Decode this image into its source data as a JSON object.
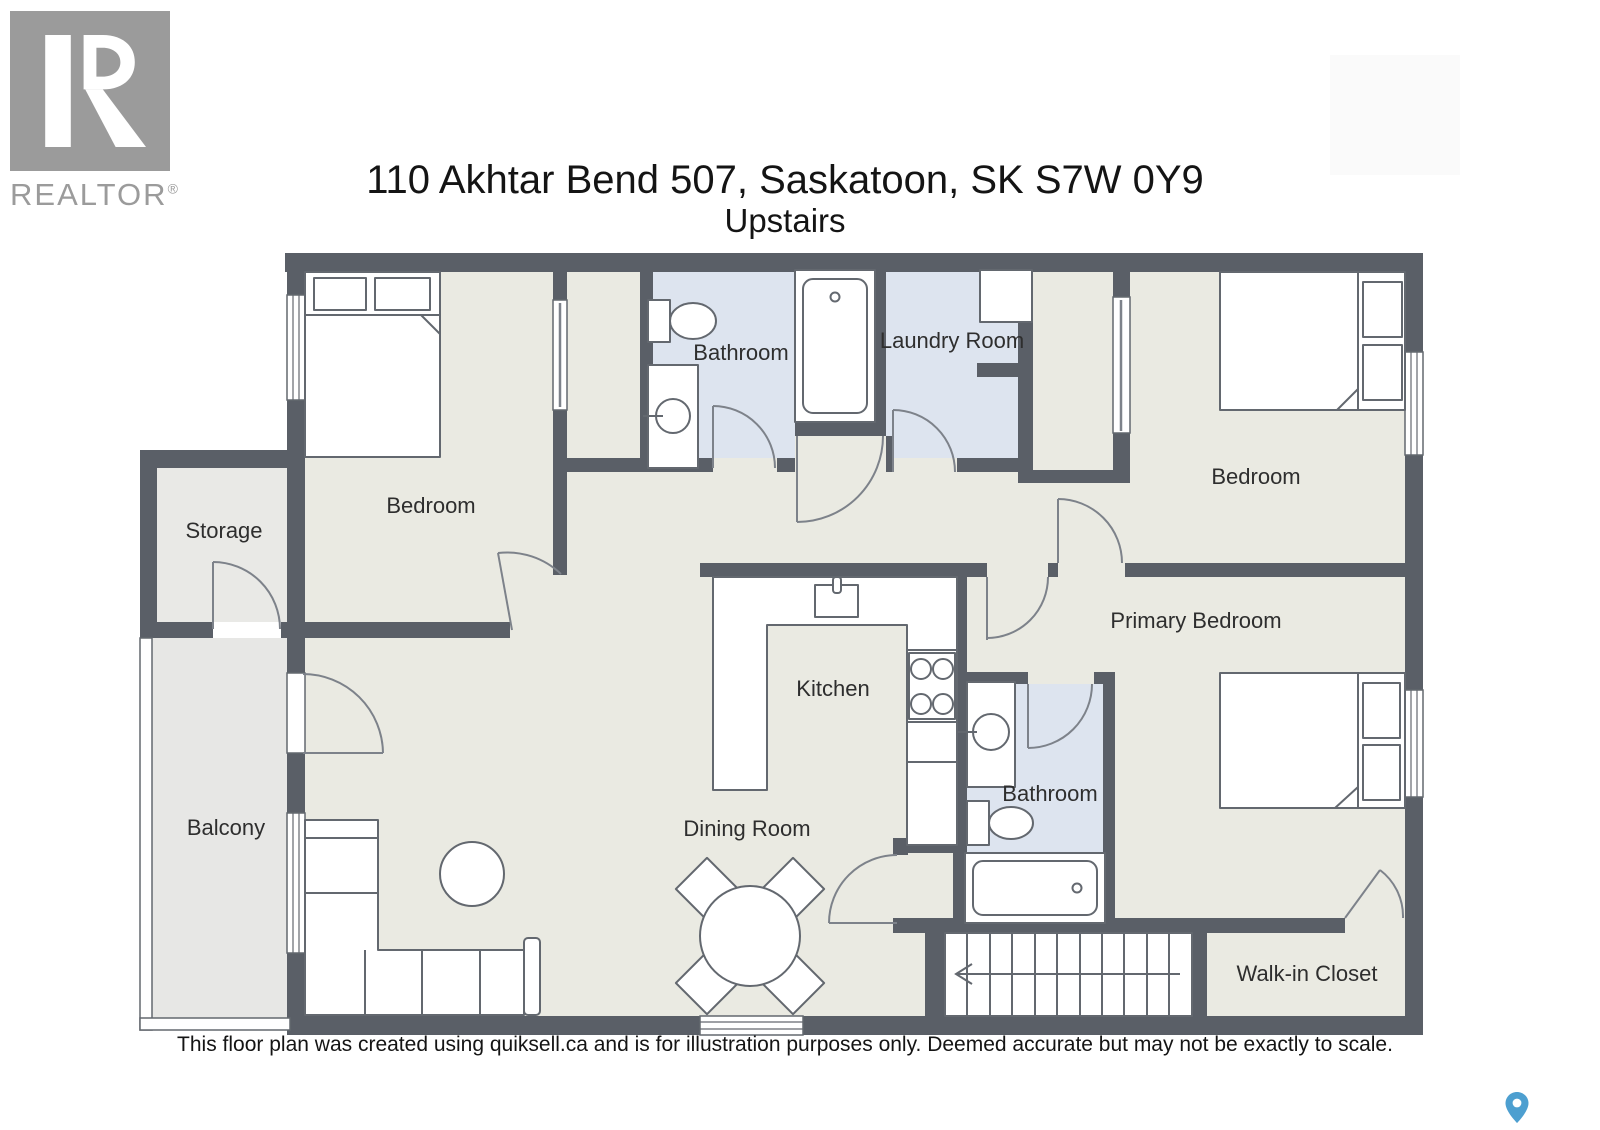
{
  "palette": {
    "wall": "#5a5f67",
    "floor": "#eaeae2",
    "wet": "#dde4ef",
    "outdoor": "#e7e7e5",
    "storage": "#e9e9e6",
    "fstroke": "#63686f",
    "dstroke": "#7d828a",
    "pin": "#4d9fd0",
    "logo": "#9b9b9b",
    "text": "#141414"
  },
  "logo": {
    "brand": "REALTOR",
    "registered": "®"
  },
  "title": {
    "address": "110 Akhtar Bend 507, Saskatoon, SK S7W 0Y9",
    "floor": "Upstairs"
  },
  "rooms": {
    "storage": {
      "label": "Storage"
    },
    "bedroom1": {
      "label": "Bedroom"
    },
    "bathroom1": {
      "label": "Bathroom"
    },
    "laundry": {
      "label": "Laundry Room"
    },
    "bedroom2": {
      "label": "Bedroom"
    },
    "primary": {
      "label": "Primary Bedroom"
    },
    "kitchen": {
      "label": "Kitchen"
    },
    "dining": {
      "label": "Dining Room"
    },
    "bathroom2": {
      "label": "Bathroom"
    },
    "balcony": {
      "label": "Balcony"
    },
    "walkin": {
      "label": "Walk-in Closet"
    }
  },
  "footer": {
    "disclaimer": "This floor plan was created using quiksell.ca and is for illustration purposes only. Deemed accurate but may not be exactly to scale."
  }
}
